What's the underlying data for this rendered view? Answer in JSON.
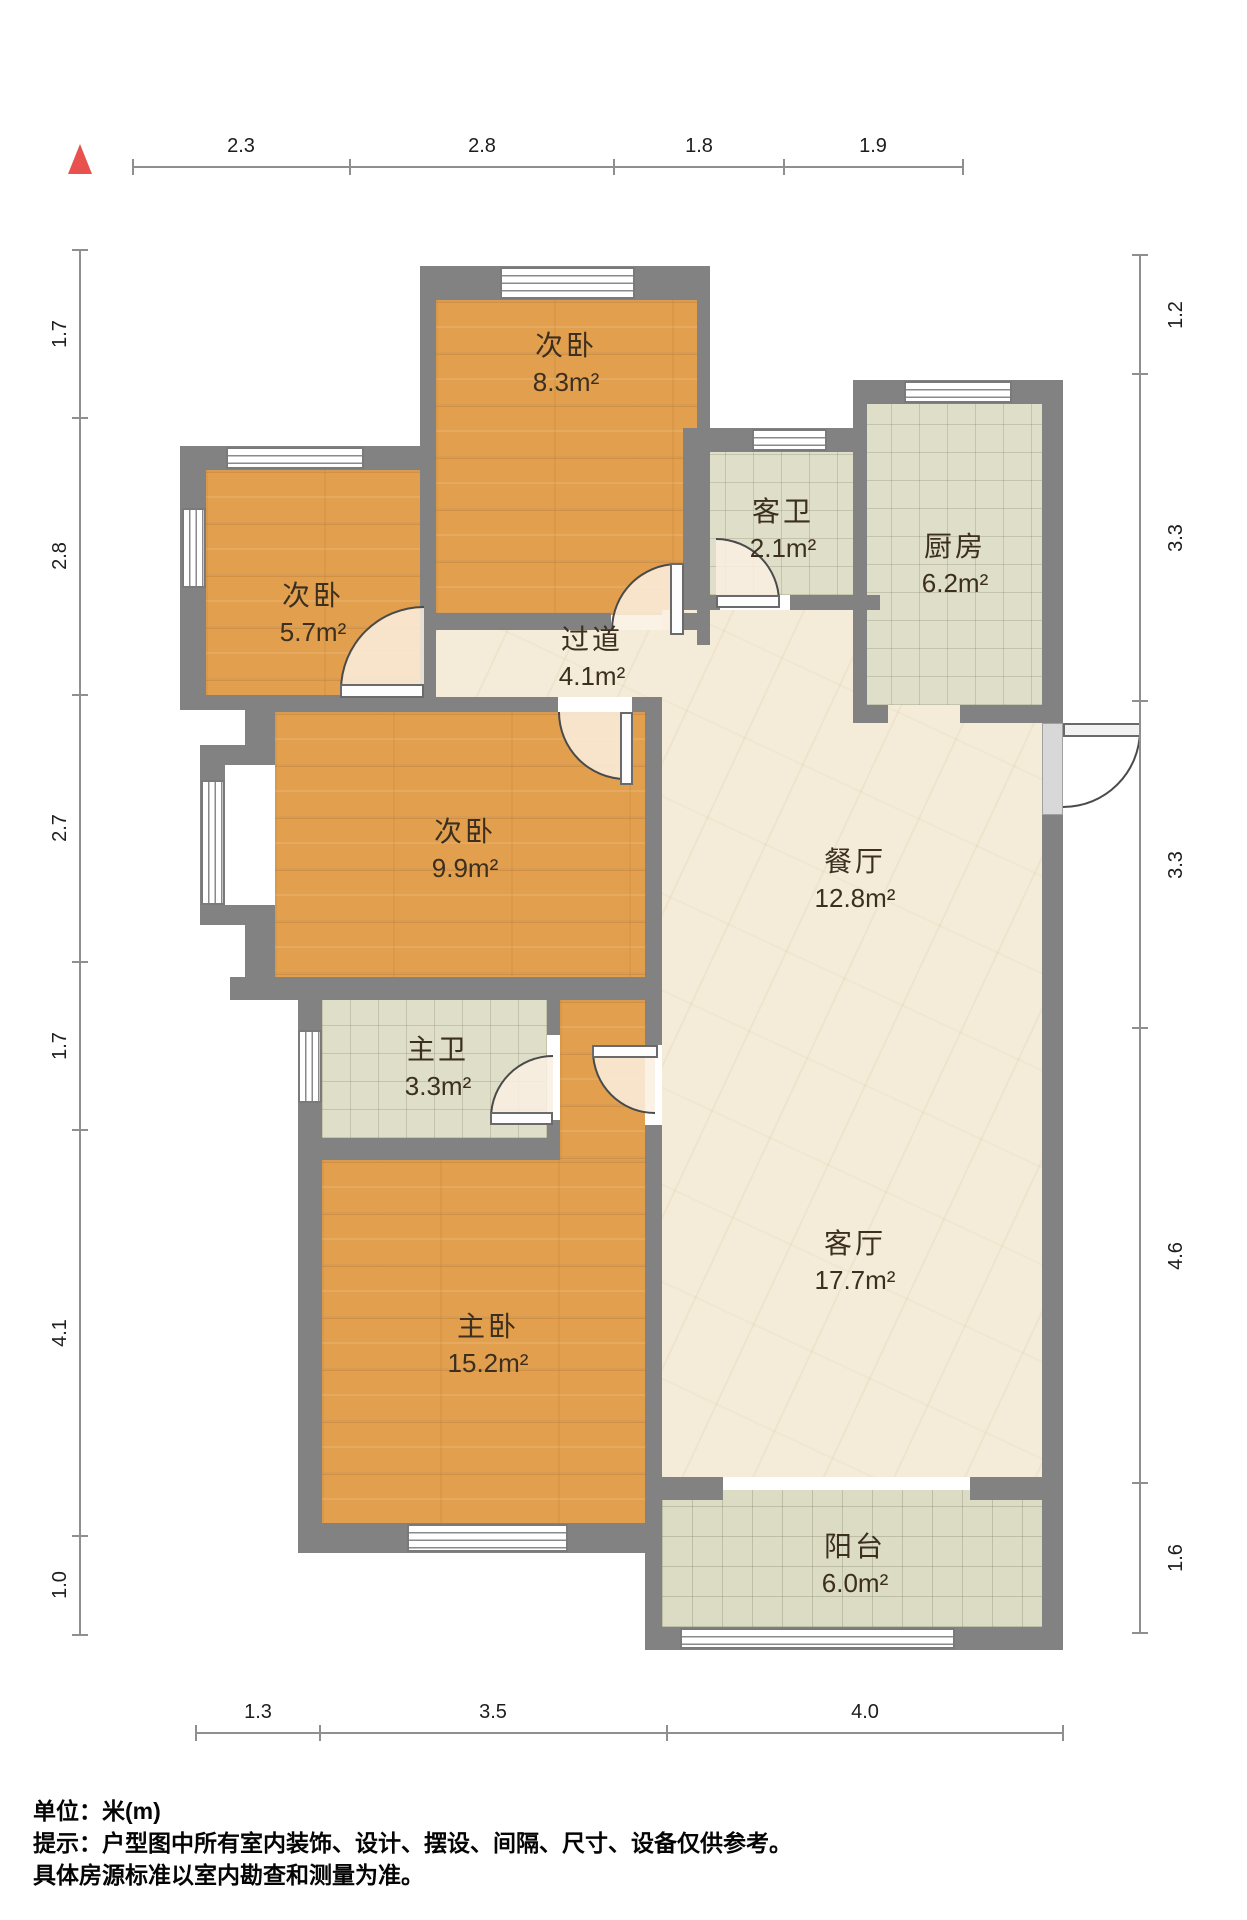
{
  "plan_title": "户型图",
  "colors": {
    "north_arrow": "#e8514e",
    "wall": "#828282",
    "wood_floor": "#e2a04e",
    "tile_floor": "#dfdec8",
    "marble_floor": "#f4ecd9"
  },
  "rooms": {
    "bedroom_top": {
      "name": "次卧",
      "area": "8.3m²"
    },
    "bedroom_left": {
      "name": "次卧",
      "area": "5.7m²"
    },
    "guest_bath": {
      "name": "客卫",
      "area": "2.1m²"
    },
    "kitchen": {
      "name": "厨房",
      "area": "6.2m²"
    },
    "hallway": {
      "name": "过道",
      "area": "4.1m²"
    },
    "bedroom_mid": {
      "name": "次卧",
      "area": "9.9m²"
    },
    "dining": {
      "name": "餐厅",
      "area": "12.8m²"
    },
    "master_bath": {
      "name": "主卫",
      "area": "3.3m²"
    },
    "master_bedroom": {
      "name": "主卧",
      "area": "15.2m²"
    },
    "living": {
      "name": "客厅",
      "area": "17.7m²"
    },
    "balcony": {
      "name": "阳台",
      "area": "6.0m²"
    }
  },
  "dimensions": {
    "top": [
      "2.3",
      "2.8",
      "1.8",
      "1.9"
    ],
    "left": [
      "1.7",
      "2.8",
      "2.7",
      "1.7",
      "4.1",
      "1.0"
    ],
    "right": [
      "1.2",
      "3.3",
      "3.3",
      "4.6",
      "1.6"
    ],
    "bottom": [
      "1.3",
      "3.5",
      "4.0"
    ]
  },
  "footer": {
    "unit_label": "单位：米(m)",
    "note_line1": "提示：户型图中所有室内装饰、设计、摆设、间隔、尺寸、设备仅供参考。",
    "note_line2": "具体房源标准以室内勘查和测量为准。"
  }
}
